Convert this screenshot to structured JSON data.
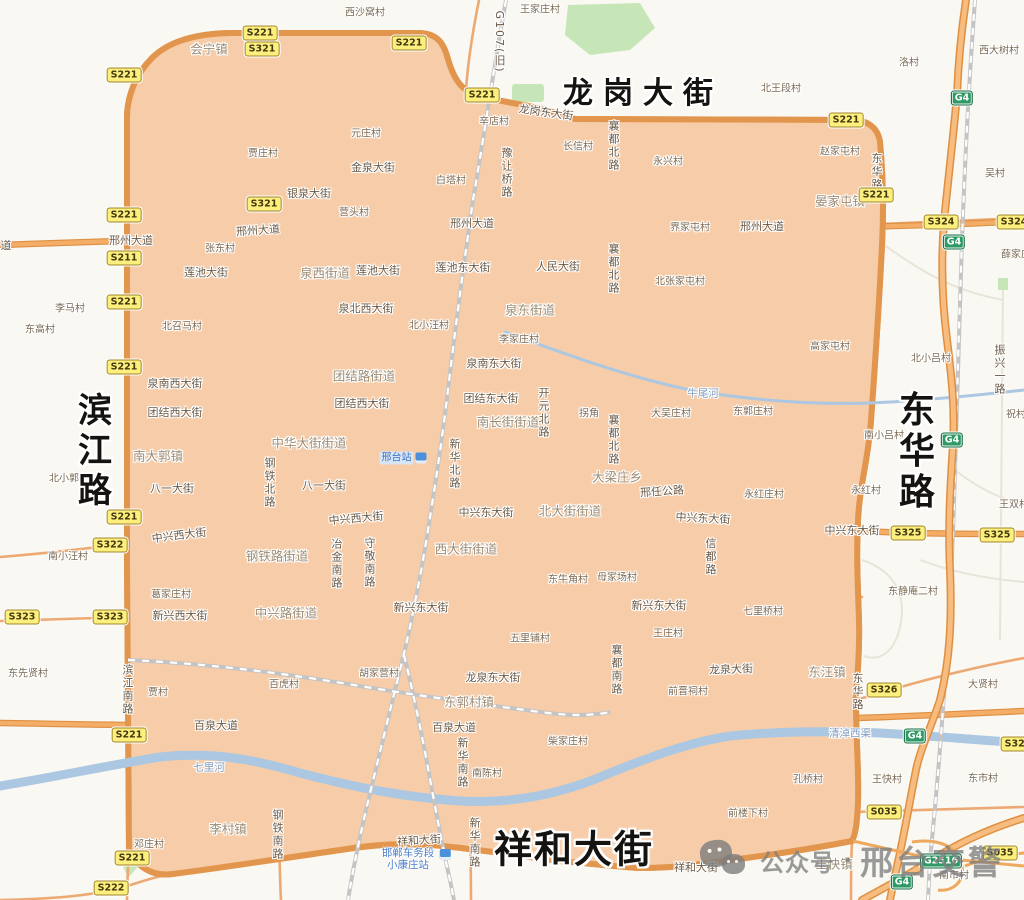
{
  "meta": {
    "width": 1024,
    "height": 900
  },
  "colors": {
    "outside_bg": "#f9f8f3",
    "zone_fill": "#f7cda9",
    "ring_casing": "#e2954d",
    "ring_core": "#f3ac64",
    "arterial": "#f0a35e",
    "minor_road": "#e4b089",
    "river": "#abc7e1",
    "park": "#c7e6b7",
    "railway": "#c4c4c4",
    "shield_yellow": "#fdef7e",
    "shield_green": "#2e9965",
    "big_label": "#151310",
    "watermark_gray": "#7d7d7d"
  },
  "watermark": {
    "icon": "wechat-official-account-icon",
    "prefix": "公众号",
    "separator": "·",
    "suffix": "邢台交警"
  },
  "stations": {
    "xingtai": "邢台站",
    "yard_line1": "邯郸车务段",
    "yard_line2": "小康庄站"
  },
  "labels": {
    "big": [
      {
        "t": "龙岗大街",
        "x": 643,
        "y": 90,
        "dir": "h",
        "size": 30,
        "ls": 10
      },
      {
        "t": "祥和大街",
        "x": 574,
        "y": 846,
        "dir": "h",
        "size": 38,
        "ls": 2
      },
      {
        "t": "滨江路",
        "x": 92,
        "y": 452,
        "dir": "v",
        "size": 34,
        "ls": 6
      },
      {
        "t": "东华路",
        "x": 913,
        "y": 452,
        "dir": "v",
        "size": 36,
        "ls": 5
      }
    ],
    "roads_h": [
      {
        "t": "龙岗东大街",
        "x": 546,
        "y": 112,
        "r": 8
      },
      {
        "t": "金泉大街",
        "x": 373,
        "y": 167
      },
      {
        "t": "银泉大街",
        "x": 309,
        "y": 193
      },
      {
        "t": "道",
        "x": 6,
        "y": 245
      },
      {
        "t": "邢州大道",
        "x": 131,
        "y": 240
      },
      {
        "t": "邢州大道",
        "x": 258,
        "y": 230,
        "r": -4
      },
      {
        "t": "邢州大道",
        "x": 472,
        "y": 223
      },
      {
        "t": "邢州大道",
        "x": 762,
        "y": 226
      },
      {
        "t": "莲池大街",
        "x": 206,
        "y": 272
      },
      {
        "t": "莲池大街",
        "x": 378,
        "y": 270
      },
      {
        "t": "莲池东大街",
        "x": 463,
        "y": 267
      },
      {
        "t": "人民大街",
        "x": 558,
        "y": 266
      },
      {
        "t": "泉北西大街",
        "x": 366,
        "y": 308
      },
      {
        "t": "泉南西大街",
        "x": 175,
        "y": 383
      },
      {
        "t": "泉南东大街",
        "x": 494,
        "y": 363
      },
      {
        "t": "团结西大街",
        "x": 175,
        "y": 412
      },
      {
        "t": "团结西大街",
        "x": 362,
        "y": 403
      },
      {
        "t": "团结东大街",
        "x": 491,
        "y": 398
      },
      {
        "t": "八一大街",
        "x": 172,
        "y": 488
      },
      {
        "t": "八一大街",
        "x": 324,
        "y": 485
      },
      {
        "t": "中兴西大街",
        "x": 179,
        "y": 535,
        "r": -7
      },
      {
        "t": "中兴西大街",
        "x": 356,
        "y": 518,
        "r": -5
      },
      {
        "t": "中兴东大街",
        "x": 486,
        "y": 512
      },
      {
        "t": "中兴东大街",
        "x": 703,
        "y": 518,
        "r": 3
      },
      {
        "t": "中兴东大街",
        "x": 852,
        "y": 530
      },
      {
        "t": "新兴西大街",
        "x": 180,
        "y": 615
      },
      {
        "t": "新兴东大街",
        "x": 421,
        "y": 607
      },
      {
        "t": "新兴东大街",
        "x": 659,
        "y": 605
      },
      {
        "t": "龙泉东大街",
        "x": 493,
        "y": 677
      },
      {
        "t": "龙泉大街",
        "x": 731,
        "y": 669,
        "r": -2
      },
      {
        "t": "邢任公路",
        "x": 662,
        "y": 491,
        "r": -4
      },
      {
        "t": "百泉大道",
        "x": 216,
        "y": 725
      },
      {
        "t": "百泉大道",
        "x": 454,
        "y": 727
      },
      {
        "t": "祥和大街",
        "x": 419,
        "y": 840,
        "r": -4
      },
      {
        "t": "祥和大街",
        "x": 696,
        "y": 867
      }
    ],
    "roads_v": [
      {
        "t": "G107(旧)",
        "x": 499,
        "y": 42
      },
      {
        "t": "豫让桥路",
        "x": 506,
        "y": 173
      },
      {
        "t": "襄都北路",
        "x": 613,
        "y": 146
      },
      {
        "t": "襄都北路",
        "x": 613,
        "y": 269
      },
      {
        "t": "襄都北路",
        "x": 613,
        "y": 440
      },
      {
        "t": "襄都南路",
        "x": 616,
        "y": 670
      },
      {
        "t": "东华路",
        "x": 876,
        "y": 172
      },
      {
        "t": "东华路",
        "x": 857,
        "y": 692
      },
      {
        "t": "开元北路",
        "x": 543,
        "y": 413
      },
      {
        "t": "新华北路",
        "x": 454,
        "y": 464
      },
      {
        "t": "钢铁北路",
        "x": 269,
        "y": 483
      },
      {
        "t": "冶金南路",
        "x": 336,
        "y": 564
      },
      {
        "t": "守敬南路",
        "x": 369,
        "y": 563
      },
      {
        "t": "信都路",
        "x": 710,
        "y": 557
      },
      {
        "t": "滨江南路",
        "x": 127,
        "y": 690
      },
      {
        "t": "新华南路",
        "x": 462,
        "y": 763
      },
      {
        "t": "新华南路",
        "x": 474,
        "y": 843
      },
      {
        "t": "钢铁南路",
        "x": 277,
        "y": 835
      },
      {
        "t": "振兴一路",
        "x": 999,
        "y": 370
      }
    ],
    "towns": [
      {
        "t": "会宁镇",
        "x": 209,
        "y": 48
      },
      {
        "t": "晏家屯镇",
        "x": 840,
        "y": 200
      },
      {
        "t": "泉西街道",
        "x": 325,
        "y": 272
      },
      {
        "t": "泉东街道",
        "x": 530,
        "y": 309
      },
      {
        "t": "团结路街道",
        "x": 364,
        "y": 375
      },
      {
        "t": "中华大街街道",
        "x": 309,
        "y": 442
      },
      {
        "t": "南大郭镇",
        "x": 158,
        "y": 455
      },
      {
        "t": "南长街街道",
        "x": 508,
        "y": 421
      },
      {
        "t": "大梁庄乡",
        "x": 617,
        "y": 476
      },
      {
        "t": "北大街街道",
        "x": 570,
        "y": 510
      },
      {
        "t": "西大街街道",
        "x": 466,
        "y": 548
      },
      {
        "t": "钢铁路街道",
        "x": 277,
        "y": 555
      },
      {
        "t": "中兴路街道",
        "x": 286,
        "y": 612
      },
      {
        "t": "东汪镇",
        "x": 827,
        "y": 671
      },
      {
        "t": "东郭村镇",
        "x": 469,
        "y": 701
      },
      {
        "t": "李村镇",
        "x": 228,
        "y": 828
      },
      {
        "t": "王快镇",
        "x": 834,
        "y": 863
      }
    ],
    "villages": [
      {
        "t": "西沙窝村",
        "x": 365,
        "y": 11
      },
      {
        "t": "王家庄村",
        "x": 540,
        "y": 8
      },
      {
        "t": "北王段村",
        "x": 781,
        "y": 87
      },
      {
        "t": "洛村",
        "x": 909,
        "y": 61
      },
      {
        "t": "西大树村",
        "x": 999,
        "y": 49
      },
      {
        "t": "元庄村",
        "x": 366,
        "y": 132
      },
      {
        "t": "贾庄村",
        "x": 263,
        "y": 152
      },
      {
        "t": "白塔村",
        "x": 451,
        "y": 179
      },
      {
        "t": "辛店村",
        "x": 494,
        "y": 120
      },
      {
        "t": "营头村",
        "x": 354,
        "y": 211
      },
      {
        "t": "长信村",
        "x": 578,
        "y": 145
      },
      {
        "t": "永兴村",
        "x": 668,
        "y": 160
      },
      {
        "t": "赵家屯村",
        "x": 840,
        "y": 150
      },
      {
        "t": "界家屯村",
        "x": 690,
        "y": 226
      },
      {
        "t": "薛家庄",
        "x": 1016,
        "y": 253
      },
      {
        "t": "张东村",
        "x": 220,
        "y": 247
      },
      {
        "t": "北张家屯村",
        "x": 680,
        "y": 280
      },
      {
        "t": "李马村",
        "x": 70,
        "y": 307
      },
      {
        "t": "东高村",
        "x": 40,
        "y": 328
      },
      {
        "t": "北召马村",
        "x": 182,
        "y": 325
      },
      {
        "t": "北小汪村",
        "x": 429,
        "y": 324
      },
      {
        "t": "李家庄村",
        "x": 519,
        "y": 338
      },
      {
        "t": "高家屯村",
        "x": 830,
        "y": 345
      },
      {
        "t": "吴村",
        "x": 995,
        "y": 172
      },
      {
        "t": "拐角",
        "x": 589,
        "y": 412
      },
      {
        "t": "大吴庄村",
        "x": 671,
        "y": 412
      },
      {
        "t": "东郭庄村",
        "x": 753,
        "y": 410
      },
      {
        "t": "北小吕村",
        "x": 931,
        "y": 357
      },
      {
        "t": "祝村",
        "x": 1016,
        "y": 413
      },
      {
        "t": "南小吕村",
        "x": 884,
        "y": 434
      },
      {
        "t": "王双村",
        "x": 1014,
        "y": 503
      },
      {
        "t": "永红村",
        "x": 866,
        "y": 489
      },
      {
        "t": "永红庄村",
        "x": 764,
        "y": 493
      },
      {
        "t": "北小郭村",
        "x": 69,
        "y": 477
      },
      {
        "t": "南小汪村",
        "x": 68,
        "y": 555
      },
      {
        "t": "东牛角村",
        "x": 568,
        "y": 578
      },
      {
        "t": "母家场村",
        "x": 617,
        "y": 576
      },
      {
        "t": "东静庵二村",
        "x": 913,
        "y": 590
      },
      {
        "t": "葛家庄村",
        "x": 171,
        "y": 593
      },
      {
        "t": "七里桥村",
        "x": 763,
        "y": 610
      },
      {
        "t": "五里铺村",
        "x": 530,
        "y": 637
      },
      {
        "t": "王庄村",
        "x": 668,
        "y": 632
      },
      {
        "t": "大贤村",
        "x": 983,
        "y": 683
      },
      {
        "t": "前晋祠村",
        "x": 688,
        "y": 690
      },
      {
        "t": "贾村",
        "x": 158,
        "y": 691
      },
      {
        "t": "百虎村",
        "x": 284,
        "y": 683
      },
      {
        "t": "胡家营村",
        "x": 379,
        "y": 672
      },
      {
        "t": "东先贤村",
        "x": 28,
        "y": 672
      },
      {
        "t": "南陈村",
        "x": 487,
        "y": 772
      },
      {
        "t": "柴家庄村",
        "x": 568,
        "y": 740
      },
      {
        "t": "孔桥村",
        "x": 808,
        "y": 778
      },
      {
        "t": "王快村",
        "x": 887,
        "y": 778
      },
      {
        "t": "东市村",
        "x": 983,
        "y": 777
      },
      {
        "t": "前楼下村",
        "x": 748,
        "y": 812
      },
      {
        "t": "邓庄村",
        "x": 149,
        "y": 843
      },
      {
        "t": "南市村",
        "x": 954,
        "y": 874
      }
    ],
    "waters": [
      {
        "t": "牛尾河",
        "x": 703,
        "y": 393
      },
      {
        "t": "七里河",
        "x": 209,
        "y": 767
      },
      {
        "t": "清淖西渠",
        "x": 850,
        "y": 733
      }
    ],
    "shields": [
      {
        "code": "S221",
        "type": "y",
        "x": 260,
        "y": 33
      },
      {
        "code": "S321",
        "type": "y",
        "x": 262,
        "y": 49
      },
      {
        "code": "S221",
        "type": "y",
        "x": 409,
        "y": 43
      },
      {
        "code": "S221",
        "type": "y",
        "x": 124,
        "y": 75
      },
      {
        "code": "S221",
        "type": "y",
        "x": 482,
        "y": 95
      },
      {
        "code": "S221",
        "type": "y",
        "x": 846,
        "y": 120
      },
      {
        "code": "S221",
        "type": "y",
        "x": 876,
        "y": 195
      },
      {
        "code": "S321",
        "type": "y",
        "x": 264,
        "y": 204
      },
      {
        "code": "S221",
        "type": "y",
        "x": 124,
        "y": 215
      },
      {
        "code": "S211",
        "type": "y",
        "x": 124,
        "y": 258
      },
      {
        "code": "S221",
        "type": "y",
        "x": 124,
        "y": 302
      },
      {
        "code": "S221",
        "type": "y",
        "x": 124,
        "y": 367
      },
      {
        "code": "S221",
        "type": "y",
        "x": 124,
        "y": 517
      },
      {
        "code": "S322",
        "type": "y",
        "x": 110,
        "y": 545
      },
      {
        "code": "S323",
        "type": "y",
        "x": 22,
        "y": 617
      },
      {
        "code": "S323",
        "type": "y",
        "x": 110,
        "y": 617
      },
      {
        "code": "S324",
        "type": "y",
        "x": 941,
        "y": 222
      },
      {
        "code": "S324",
        "type": "y",
        "x": 1014,
        "y": 222
      },
      {
        "code": "S325",
        "type": "y",
        "x": 908,
        "y": 533
      },
      {
        "code": "S325",
        "type": "y",
        "x": 997,
        "y": 535
      },
      {
        "code": "S325",
        "type": "y",
        "x": 1018,
        "y": 744
      },
      {
        "code": "S326",
        "type": "y",
        "x": 884,
        "y": 690
      },
      {
        "code": "S035",
        "type": "y",
        "x": 884,
        "y": 812
      },
      {
        "code": "S035",
        "type": "y",
        "x": 1000,
        "y": 853
      },
      {
        "code": "S221",
        "type": "y",
        "x": 129,
        "y": 735
      },
      {
        "code": "S221",
        "type": "y",
        "x": 132,
        "y": 858
      },
      {
        "code": "S222",
        "type": "y",
        "x": 111,
        "y": 888
      },
      {
        "code": "G4",
        "type": "g",
        "x": 962,
        "y": 98
      },
      {
        "code": "G4",
        "type": "g",
        "x": 954,
        "y": 242
      },
      {
        "code": "G4",
        "type": "g",
        "x": 952,
        "y": 440
      },
      {
        "code": "G4",
        "type": "g",
        "x": 915,
        "y": 736
      },
      {
        "code": "G2516",
        "type": "g",
        "x": 941,
        "y": 861
      },
      {
        "code": "G4",
        "type": "g",
        "x": 902,
        "y": 882
      }
    ]
  }
}
